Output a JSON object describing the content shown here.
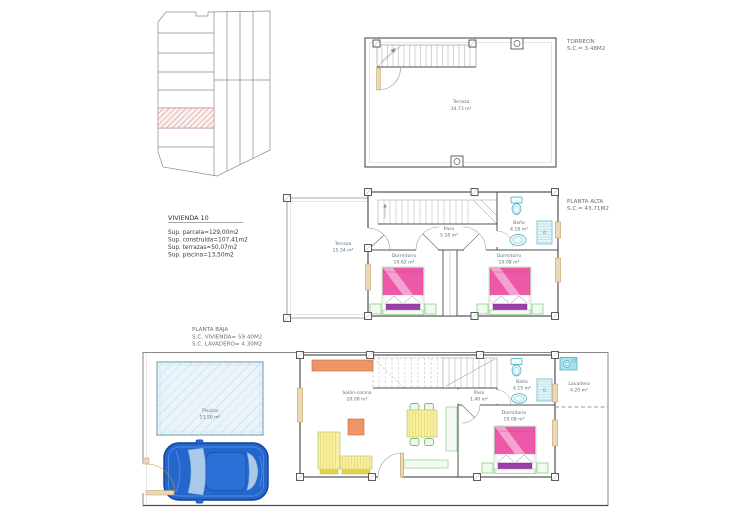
{
  "torreon": {
    "title": "TORREON",
    "area": "S.C.= 3.48M2",
    "terraza_name": "Terraza",
    "terraza_area": "34.73 m²"
  },
  "vivienda": {
    "title": "VIVIENDA 10",
    "line1": "Sup. parcela=129,00m2",
    "line2": "Sup. construida=107,41m2",
    "line3": "Sup. terrazas=50,07m2",
    "line4": "Sup. piscina=13,50m2"
  },
  "planta_alta": {
    "title": "PLANTA ALTA",
    "area": "S.C.= 43.71M2",
    "terraza_name": "Terraza",
    "terraza_area": "15.34 m²",
    "paso_name": "Paso",
    "paso_area": "5.18 m²",
    "bano_name": "Baño",
    "bano_area": "4.18 m²",
    "dormitorio1_name": "Dormitorio",
    "dormitorio1_area": "10.62 m²",
    "dormitorio2_name": "Dormitorio",
    "dormitorio2_area": "10.08 m²"
  },
  "planta_baja": {
    "title": "PLANTA BAJA",
    "line1": "S.C. VIVIENDA= 59.40M2",
    "line2": "S.C. LAVADERO= 4.30M2",
    "salon_name": "Salón-cocina",
    "salon_area": "20.08 m²",
    "paso_name": "Paso",
    "paso_area": "1.40 m²",
    "bano_name": "Baño",
    "bano_area": "4.15 m²",
    "lavadero_name": "Lavadero",
    "lavadero_area": "4.20 m²",
    "dormitorio_name": "Dormitorio",
    "dormitorio_area": "10.08 m²",
    "piscina_name": "Piscina",
    "piscina_area": "13.50 m²"
  },
  "colors": {
    "wall": "#4f4f4f",
    "bed_pink": "#ee58a8",
    "bed_stripe": "#f4a3d0",
    "bed_purple": "#9b3fa8",
    "furniture_green": "#7cc87c",
    "furniture_yellow": "#f8f0a0",
    "kitchen_orange": "#ef9468",
    "fixture_cyan": "#3aa8bc",
    "pool_fill": "#eaf4fa",
    "car_blue": "#2367cd",
    "window_beige": "#ead9b8",
    "hatch_red": "#d08585"
  }
}
